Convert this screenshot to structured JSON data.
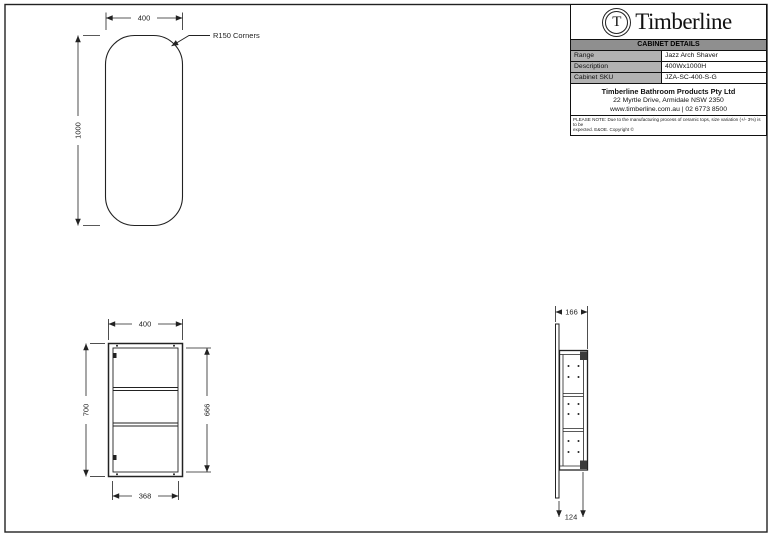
{
  "title_block": {
    "logo": {
      "letter": "T",
      "brand": "Timberline"
    },
    "header": "CABINET DETAILS",
    "rows": [
      {
        "label": "Range",
        "value": "Jazz Arch Shaver"
      },
      {
        "label": "Description",
        "value": "400Wx1000H"
      },
      {
        "label": "Cabinet SKU",
        "value": "JZA-SC-400-S-G"
      }
    ],
    "company": {
      "name": "Timberline Bathroom Products Pty Ltd",
      "address": "22 Myrtle Drive, Armidale NSW 2350",
      "contact": "www.timberline.com.au  |  02 6773 8500"
    },
    "note_line1": "PLEASE NOTE: Due to the manufacturing process of ceramic tops, size variation (+/- 3%) is to be",
    "note_line2": "expected. E&OE. Copyright ©"
  },
  "views": {
    "mirror_front": {
      "width_dim": "400",
      "height_dim": "1000",
      "corner_label": "R150 Corners"
    },
    "cabinet_front": {
      "width_dim": "400",
      "height_dim": "700",
      "inner_height_dim": "666",
      "inner_width_dim": "368"
    },
    "cabinet_side": {
      "overall_depth_dim": "166",
      "cabinet_depth_dim": "124"
    }
  },
  "colors": {
    "line": "#222222",
    "table_header_bg": "#8f8f8f",
    "table_label_bg": "#b2b2b2",
    "paper": "#ffffff"
  }
}
